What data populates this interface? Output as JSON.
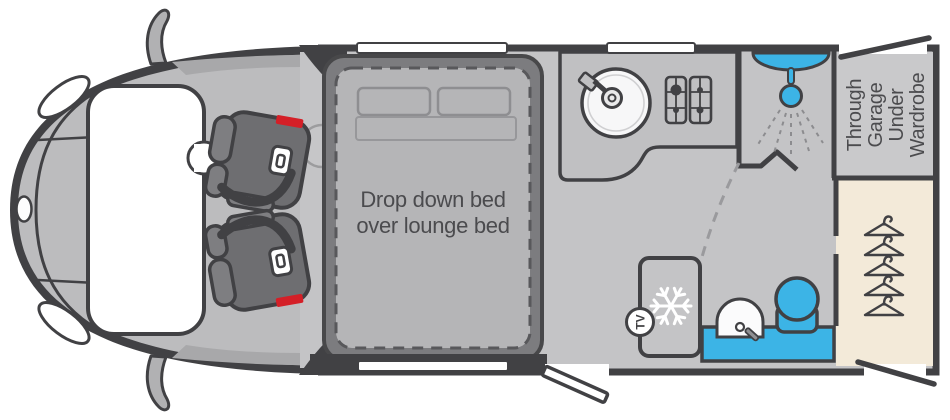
{
  "floorplan": {
    "type": "motorhome-floorplan-top-view",
    "labels": {
      "bed": {
        "line1": "Drop down bed",
        "line2": "over lounge bed"
      },
      "garage": {
        "line1": "Through",
        "line2": "Garage",
        "line3": "Under",
        "line4": "Wardrobe"
      },
      "tv": "TV"
    },
    "icons": [
      "wing-mirror-icon",
      "headlight-icon",
      "windscreen",
      "seatbelt-buckle-icon",
      "pillow-icon",
      "sink-icon",
      "tap-icon",
      "hob-burners-icon",
      "shower-head-icon",
      "shower-spray-icon",
      "folding-door-icon",
      "swing-door-path-icon",
      "snowflake-icon",
      "tv-badge-icon",
      "washbasin-icon",
      "toilet-icon",
      "coat-hanger-icon",
      "window-strip",
      "entry-door-open-icon",
      "garage-hatch-open-icon"
    ],
    "colors": {
      "outline": "#414144",
      "floor": "#c4c4c6",
      "cab_body": "#bcbcbe",
      "bed_base": "#7c7c7f",
      "mattress": "#b5b5b7",
      "counter": "#c0c0c2",
      "water_blue": "#3cb4e6",
      "wardrobe_beige": "#f3ead9",
      "garage_floor": "#c9c9cb",
      "seat_gray": "#6e6e71",
      "belt_red": "#d41f27",
      "label_text": "#4b4b4e",
      "white": "#ffffff"
    }
  }
}
